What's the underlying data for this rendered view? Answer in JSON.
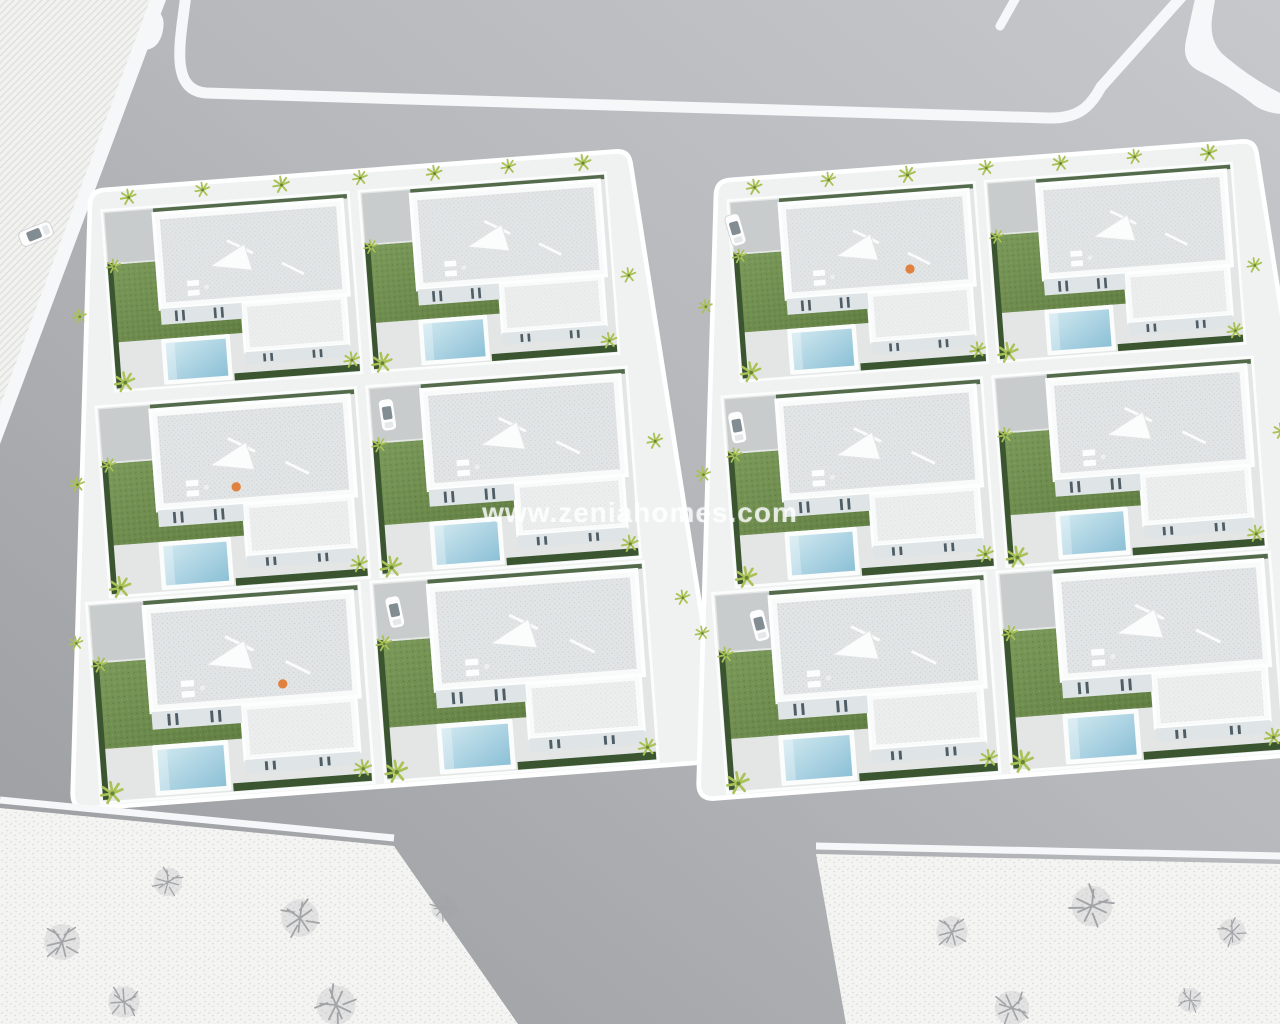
{
  "scene": {
    "type": "aerial-3d-architectural-render",
    "subject": "residential villa development with two blocks of white villas, private pools, gardens, palm trees, surrounding roads and vacant plots",
    "watermark": "www.zeniahomes.com"
  },
  "palette": {
    "road_light": "#c6c8cc",
    "road_mid": "#b6b8bc",
    "road_dark": "#a6a8ab",
    "marking": "#f6f7f8",
    "sidewalk": "#f0f2f1",
    "paving": "#e3e6e5",
    "driveway": "#c9cccc",
    "hatch_bg": "#f1f1ef",
    "hatch_line": "#dcdcd9",
    "plot_bg": "#f4f4f2",
    "plot_line": "#d8d9d6",
    "roof": "#e2e5e6",
    "roof_light": "#eceeee",
    "wall": "#f9fafa",
    "wall_shade": "#dfe4e6",
    "window": "#4f5e66",
    "grass_light": "#7b9a5a",
    "grass": "#627f43",
    "hedge": "#3a5530",
    "pool_light": "#cfe8f0",
    "pool_deep": "#8cc0d6",
    "palm": "#a9c155",
    "palm_dark": "#66843a",
    "tree_gray": "#a2a4a7",
    "car_glass": "#6b7880",
    "orange": "#e0813f",
    "watermark": "rgba(255,255,255,0.78)"
  }
}
